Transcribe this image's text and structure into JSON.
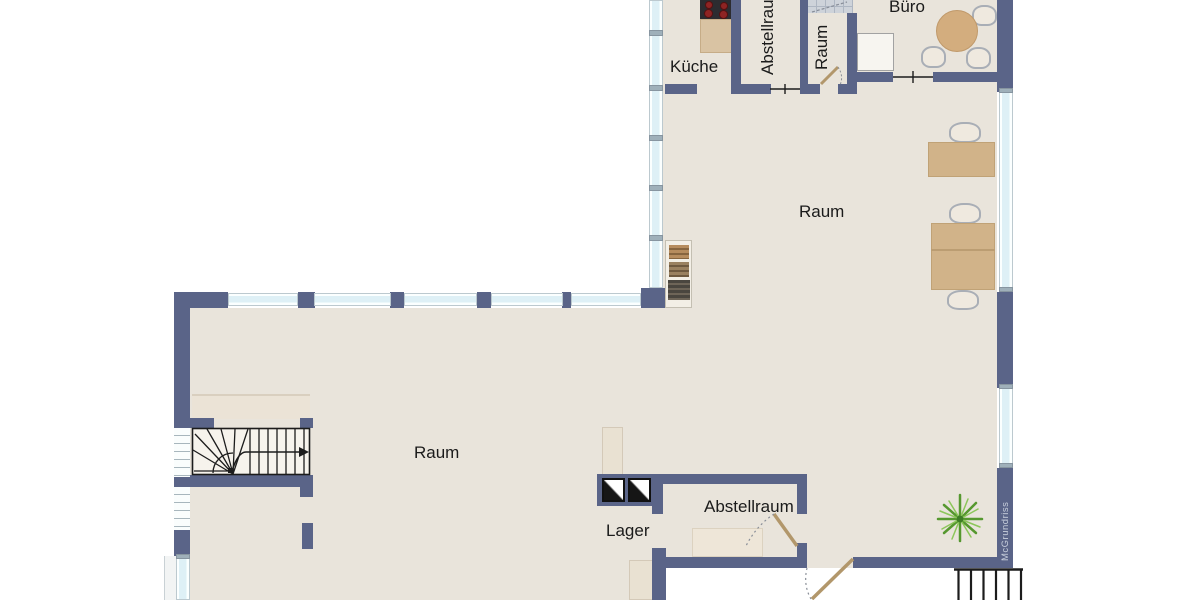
{
  "plan": {
    "watermark": "McGrundriss",
    "rooms": {
      "kueche": {
        "label": "Küche"
      },
      "abstellraum_top": {
        "label": "Abstellraum"
      },
      "raum_top": {
        "label": "Raum"
      },
      "buero": {
        "label": "Büro"
      },
      "raum_upper": {
        "label": "Raum"
      },
      "raum_lower": {
        "label": "Raum"
      },
      "lager": {
        "label": "Lager"
      },
      "abstellraum_bottom": {
        "label": "Abstellraum"
      }
    },
    "furniture": [
      "stove",
      "kitchen-counter",
      "office-round-table",
      "office-chairs",
      "white-cabinet",
      "bookshelf",
      "desk",
      "double-desk",
      "desk-chairs",
      "staircase",
      "stair-landing",
      "storage-cabinet",
      "shaft-markers",
      "plant",
      "shower",
      "exterior-stairs"
    ],
    "colors": {
      "wall": "#5a6488",
      "floor": "#e9e4db",
      "window_glass": "#def0f6",
      "furniture_wood": "#d1b389",
      "door_leaf": "#b2976b",
      "plant_green": "#56982f",
      "stove_burner": "#8e2423",
      "background": "#ffffff"
    }
  }
}
